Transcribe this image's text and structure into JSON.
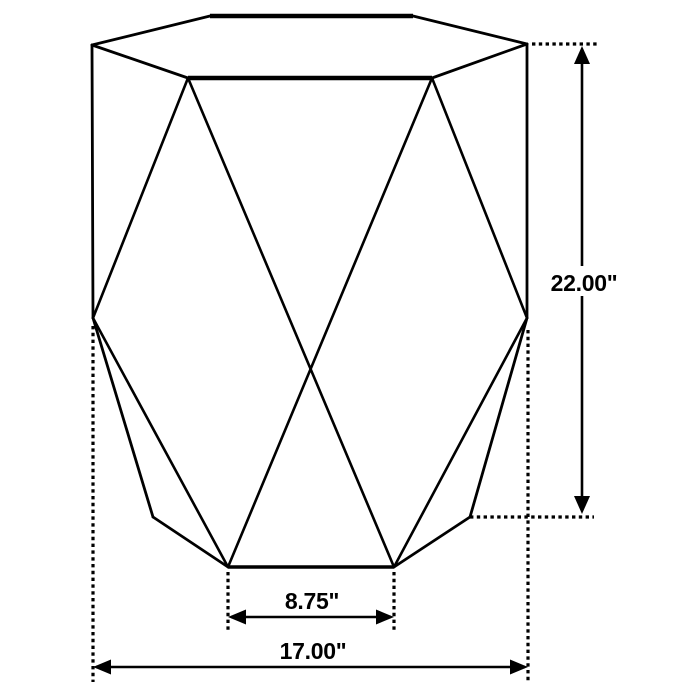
{
  "dimensions": {
    "height": {
      "label": "22.00\"",
      "value": 22.0,
      "unit": "inches"
    },
    "base_edge": {
      "label": "8.75\"",
      "value": 8.75,
      "unit": "inches"
    },
    "overall_width": {
      "label": "17.00\"",
      "value": 17.0,
      "unit": "inches"
    }
  },
  "colors": {
    "line": "#000000",
    "text": "#000000",
    "background": "#ffffff"
  }
}
